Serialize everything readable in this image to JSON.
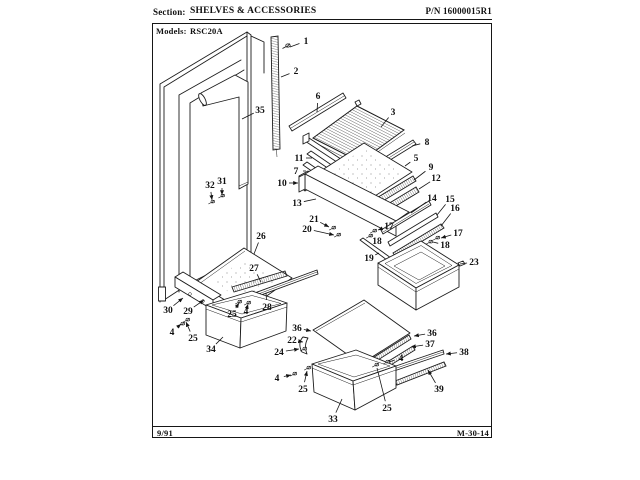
{
  "header": {
    "section_label": "Section:",
    "section_title": "SHELVES & ACCESSORIES",
    "part_number": "P/N 16000015R1",
    "models_label": "Models:",
    "models_value": "RSC20A"
  },
  "footer": {
    "date_code": "9/91",
    "doc_code": "M-30-14"
  },
  "colors": {
    "ink": "#1c1c1c",
    "paper": "#ffffff"
  },
  "diagram": {
    "callouts": [
      {
        "n": "1",
        "x": 306,
        "y": 41,
        "lx": 290,
        "ly": 47,
        "arrow": false
      },
      {
        "n": "2",
        "x": 296,
        "y": 71,
        "lx": 281,
        "ly": 77,
        "arrow": false
      },
      {
        "n": "35",
        "x": 260,
        "y": 110,
        "lx": 242,
        "ly": 119,
        "arrow": false
      },
      {
        "n": "6",
        "x": 318,
        "y": 96,
        "lx": 317,
        "ly": 112,
        "arrow": false
      },
      {
        "n": "3",
        "x": 393,
        "y": 112,
        "lx": 381,
        "ly": 127,
        "arrow": false
      },
      {
        "n": "8",
        "x": 427,
        "y": 142,
        "lx": 412,
        "ly": 146,
        "arrow": false
      },
      {
        "n": "11",
        "x": 299,
        "y": 158,
        "lx": 312,
        "ly": 158,
        "arrow": false
      },
      {
        "n": "7",
        "x": 296,
        "y": 171,
        "lx": 306,
        "ly": 171,
        "arrow": false
      },
      {
        "n": "10",
        "x": 282,
        "y": 183,
        "lx": 298,
        "ly": 183,
        "arrow": true
      },
      {
        "n": "5",
        "x": 416,
        "y": 158,
        "lx": 405,
        "ly": 166,
        "arrow": false
      },
      {
        "n": "9",
        "x": 431,
        "y": 167,
        "lx": 414,
        "ly": 180,
        "arrow": false
      },
      {
        "n": "12",
        "x": 436,
        "y": 178,
        "lx": 419,
        "ly": 189,
        "arrow": false
      },
      {
        "n": "13",
        "x": 297,
        "y": 203,
        "lx": 316,
        "ly": 199,
        "arrow": false
      },
      {
        "n": "14",
        "x": 432,
        "y": 198,
        "lx": 411,
        "ly": 213,
        "arrow": false
      },
      {
        "n": "15",
        "x": 450,
        "y": 199,
        "lx": 437,
        "ly": 215,
        "arrow": false
      },
      {
        "n": "16",
        "x": 455,
        "y": 208,
        "lx": 441,
        "ly": 226,
        "arrow": false
      },
      {
        "n": "21",
        "x": 314,
        "y": 219,
        "lx": 329,
        "ly": 227,
        "arrow": true
      },
      {
        "n": "20",
        "x": 307,
        "y": 229,
        "lx": 334,
        "ly": 235,
        "arrow": true
      },
      {
        "n": "17",
        "x": 389,
        "y": 226,
        "lx": 378,
        "ly": 230,
        "arrow": true
      },
      {
        "n": "18",
        "x": 377,
        "y": 241,
        "lx": 372,
        "ly": 237,
        "arrow": false
      },
      {
        "n": "17",
        "x": 458,
        "y": 233,
        "lx": 441,
        "ly": 238,
        "arrow": true
      },
      {
        "n": "18",
        "x": 445,
        "y": 245,
        "lx": 433,
        "ly": 242,
        "arrow": false
      },
      {
        "n": "19",
        "x": 369,
        "y": 258,
        "lx": 379,
        "ly": 253,
        "arrow": false
      },
      {
        "n": "23",
        "x": 474,
        "y": 262,
        "lx": 460,
        "ly": 264,
        "arrow": false
      },
      {
        "n": "26",
        "x": 261,
        "y": 236,
        "lx": 254,
        "ly": 254,
        "arrow": false
      },
      {
        "n": "27",
        "x": 254,
        "y": 268,
        "lx": 261,
        "ly": 282,
        "arrow": false
      },
      {
        "n": "30",
        "x": 168,
        "y": 310,
        "lx": 183,
        "ly": 298,
        "arrow": true
      },
      {
        "n": "29",
        "x": 188,
        "y": 311,
        "lx": 204,
        "ly": 300,
        "arrow": true
      },
      {
        "n": "25",
        "x": 232,
        "y": 314,
        "lx": 239,
        "ly": 303,
        "arrow": true
      },
      {
        "n": "4",
        "x": 246,
        "y": 311,
        "lx": 248,
        "ly": 304,
        "arrow": true
      },
      {
        "n": "28",
        "x": 267,
        "y": 307,
        "lx": 266,
        "ly": 293,
        "arrow": false
      },
      {
        "n": "4",
        "x": 172,
        "y": 332,
        "lx": 181,
        "ly": 324,
        "arrow": true
      },
      {
        "n": "25",
        "x": 193,
        "y": 338,
        "lx": 186,
        "ly": 322,
        "arrow": true
      },
      {
        "n": "34",
        "x": 211,
        "y": 349,
        "lx": 223,
        "ly": 337,
        "arrow": false
      },
      {
        "n": "36",
        "x": 297,
        "y": 328,
        "lx": 311,
        "ly": 331,
        "arrow": true
      },
      {
        "n": "22",
        "x": 292,
        "y": 340,
        "lx": 303,
        "ly": 342,
        "arrow": true
      },
      {
        "n": "24",
        "x": 279,
        "y": 352,
        "lx": 299,
        "ly": 349,
        "arrow": true
      },
      {
        "n": "36",
        "x": 432,
        "y": 333,
        "lx": 414,
        "ly": 336,
        "arrow": true
      },
      {
        "n": "37",
        "x": 430,
        "y": 344,
        "lx": 411,
        "ly": 347,
        "arrow": true
      },
      {
        "n": "38",
        "x": 464,
        "y": 352,
        "lx": 446,
        "ly": 354,
        "arrow": true
      },
      {
        "n": "4",
        "x": 401,
        "y": 358,
        "lx": 389,
        "ly": 362,
        "arrow": false
      },
      {
        "n": "39",
        "x": 439,
        "y": 389,
        "lx": 428,
        "ly": 370,
        "arrow": true
      },
      {
        "n": "4",
        "x": 277,
        "y": 378,
        "lx": 291,
        "ly": 375,
        "arrow": true
      },
      {
        "n": "25",
        "x": 303,
        "y": 389,
        "lx": 307,
        "ly": 371,
        "arrow": true
      },
      {
        "n": "25",
        "x": 387,
        "y": 408,
        "lx": 377,
        "ly": 368,
        "arrow": false
      },
      {
        "n": "33",
        "x": 333,
        "y": 419,
        "lx": 342,
        "ly": 399,
        "arrow": false
      },
      {
        "n": "31",
        "x": 222,
        "y": 181,
        "lx": 222,
        "ly": 195,
        "arrow": true
      },
      {
        "n": "32",
        "x": 210,
        "y": 185,
        "lx": 212,
        "ly": 200,
        "arrow": true
      }
    ]
  }
}
